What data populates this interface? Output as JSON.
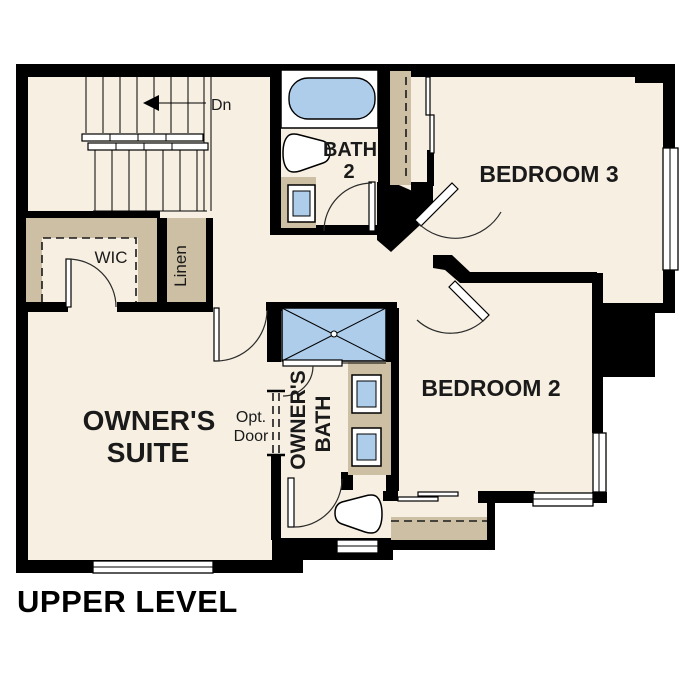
{
  "page_title": "UPPER LEVEL",
  "floor_plan": {
    "level_label": "UPPER LEVEL",
    "rooms": {
      "owners_suite": {
        "name_line1": "OWNER'S",
        "name_line2": "SUITE"
      },
      "owners_bath": {
        "name_line1": "OWNER'S",
        "name_line2": "BATH"
      },
      "bath_2": {
        "name_line1": "BATH",
        "name_line2": "2"
      },
      "bedroom_2": {
        "name": "BEDROOM 2"
      },
      "bedroom_3": {
        "name": "BEDROOM 3"
      },
      "walk_in_closet": {
        "name": "WIC"
      },
      "linen_closet": {
        "name": "Linen"
      }
    },
    "annotations": {
      "stair_direction": "Dn",
      "optional_door_line1": "Opt.",
      "optional_door_line2": "Door"
    },
    "fixtures": [
      "bathtub",
      "shower",
      "toilet",
      "sink",
      "stairs",
      "closet-shelves",
      "windows",
      "door-swings"
    ],
    "colors": {
      "floor": "#f6efe2",
      "wall": "#000000",
      "shelf_tan": "#cdbfa3",
      "fixture_blue": "#aecdea"
    }
  }
}
